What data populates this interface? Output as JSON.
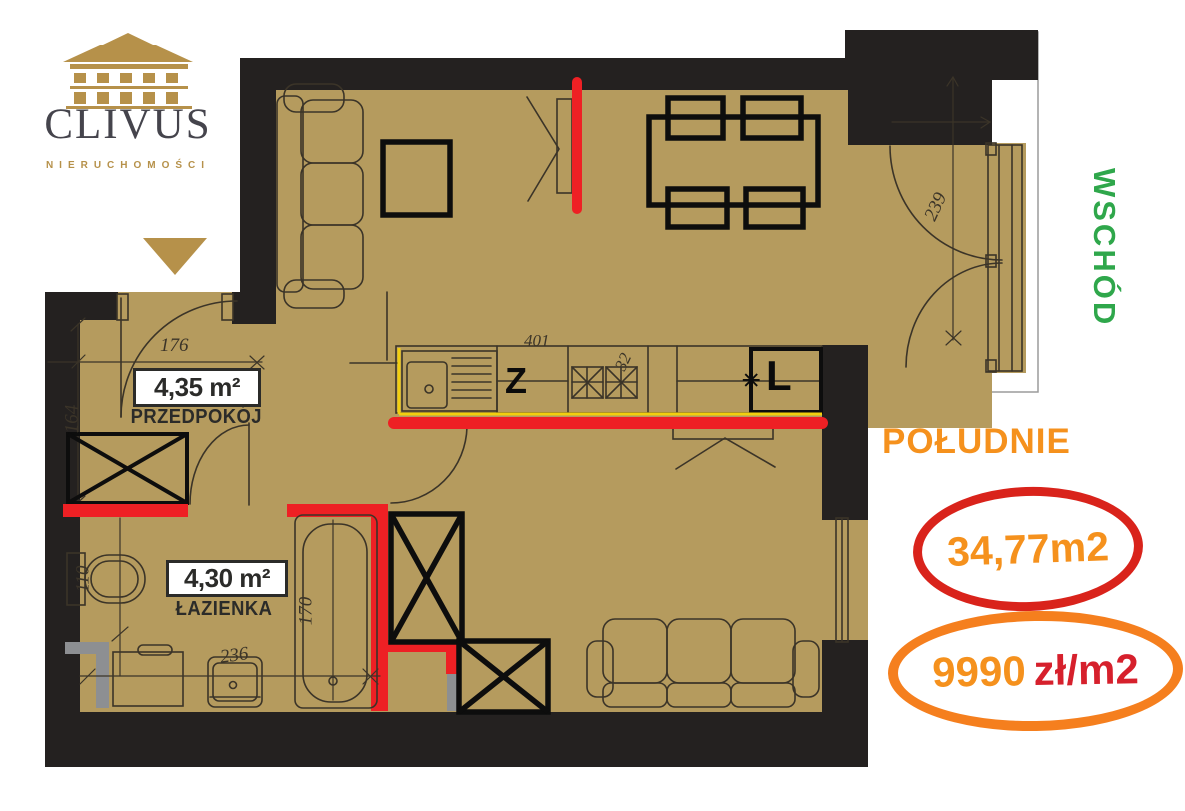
{
  "colors": {
    "floor": "#b59b5e",
    "wall": "#242120",
    "line": "#3b3428",
    "red": "#ee2024",
    "yellow": "#f2cf0e",
    "gray": "#8d8f92",
    "gold": "#b6914a",
    "green": "#2fa74b",
    "orange": "#f5911d",
    "crimson": "#d6202c",
    "ellipse_red": "#d9231b",
    "ellipse_orange": "#f57f1e",
    "logo_text": "#45444c"
  },
  "logo": {
    "company": "CLIVUS",
    "tagline": "NIERUCHOMOŚCI"
  },
  "compass": {
    "east": "WSCHÓD",
    "south": "POŁUDNIE"
  },
  "listing": {
    "total_area": "34,77m2",
    "price_value": "9990",
    "price_unit": "zł/m2"
  },
  "rooms": {
    "hall": {
      "area": "4,35 m²",
      "name": "PRZEDPOKÓJ"
    },
    "bathroom": {
      "area": "4,30 m²",
      "name": "ŁAZIENKA"
    }
  },
  "kitchen": {
    "dishwasher": "Z",
    "fridge": "L",
    "snowflake_icon": "✳"
  },
  "dimensions": {
    "hall_width": "176",
    "hall_depth": "164",
    "toilet": "110",
    "bathroom_width": "236",
    "bathtub": "170",
    "balcony_door": "239",
    "kitchen_width": "401",
    "hood": "32"
  }
}
